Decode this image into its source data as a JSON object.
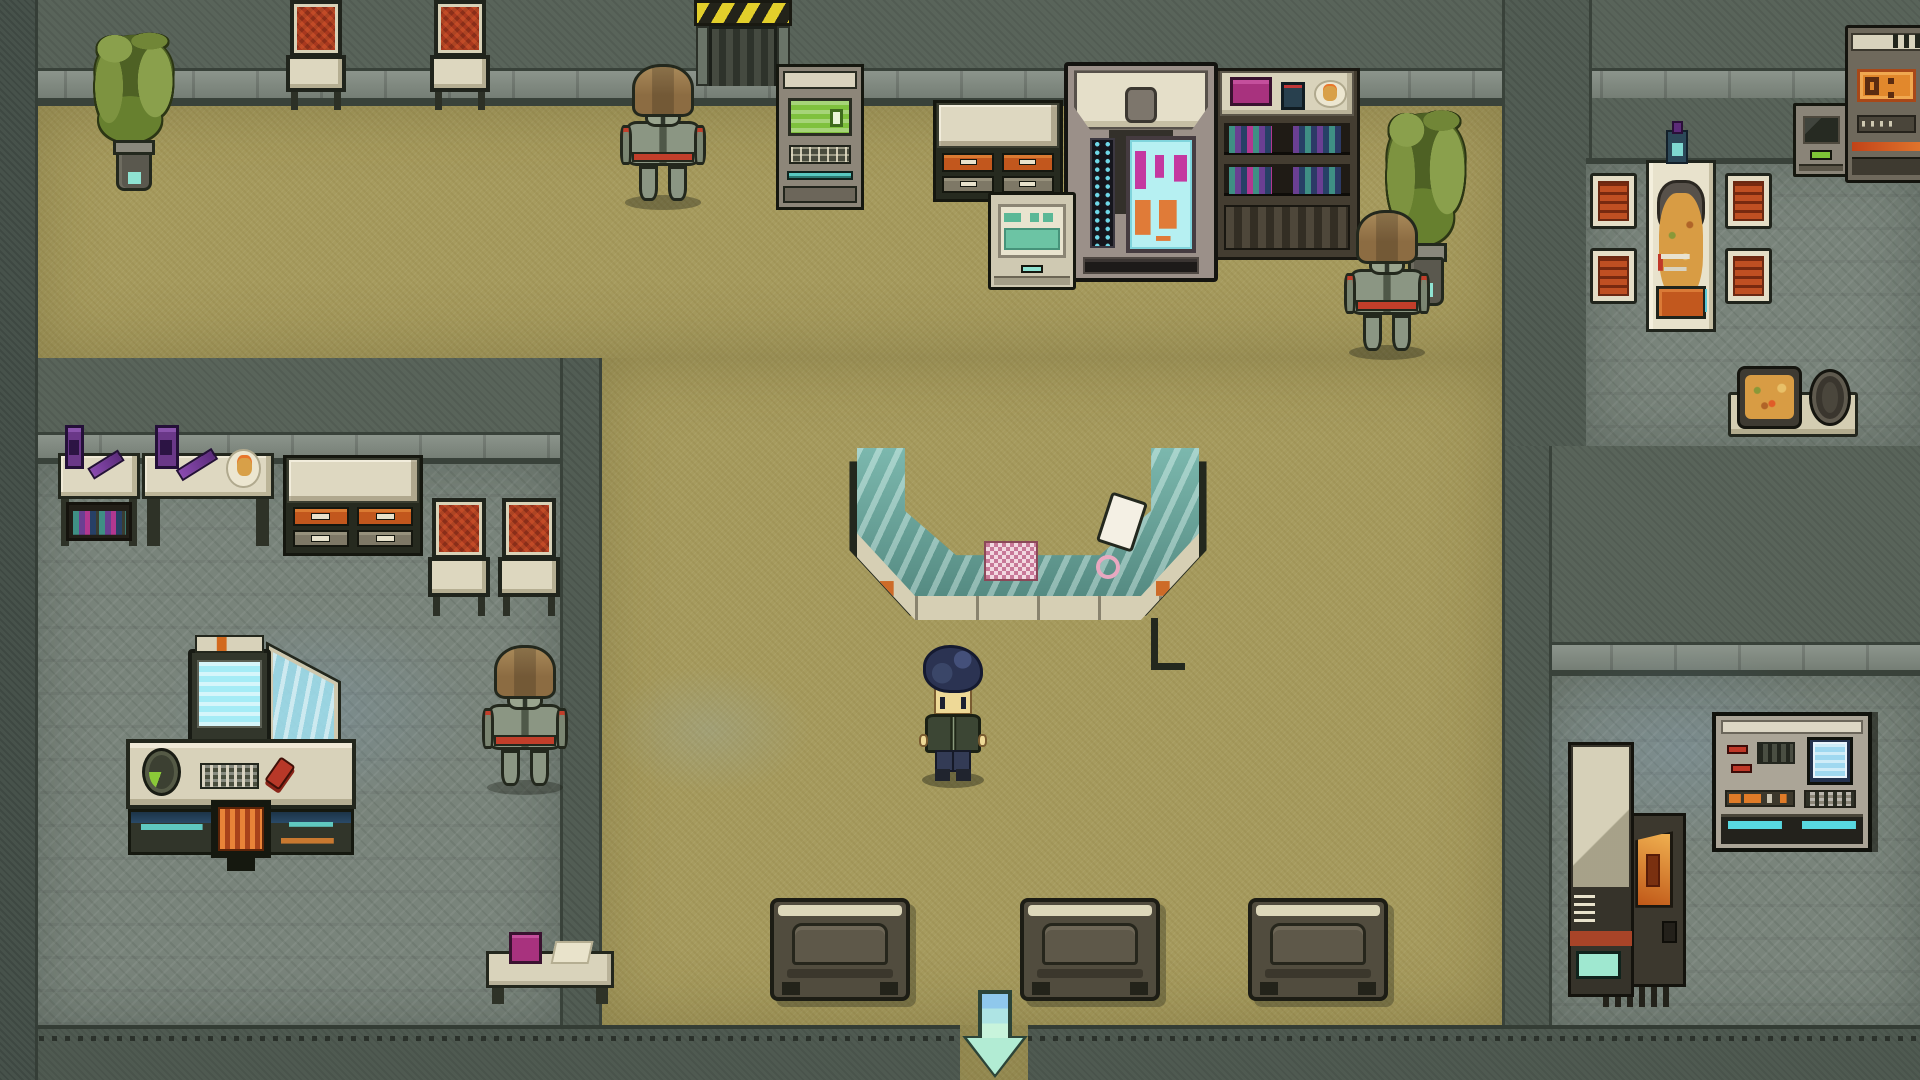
{
  "app": {
    "title": "top-down-pixel-rpg-interior",
    "view": "sci-fi lobby with service counter, side rooms, robot guards and exit arrow"
  },
  "palette": {
    "floor_tan": "#a69b5e",
    "floor_tile": "#79847b",
    "wall": "#59645a",
    "wall_trim": "#7c867c",
    "outline": "#23281d",
    "cream": "#ded8c1",
    "orange_accent": "#c2571d",
    "red_chair": "#a8381e",
    "robot_brown": "#8c6c42",
    "robot_armor": "#8b9683",
    "robot_red": "#c23e2a",
    "screen_green": "#7fc13d",
    "screen_cyan": "#b6f0f2",
    "magenta": "#c438a0",
    "teal": "#58c8c0",
    "glass_teal": "#639f95",
    "hazard_yellow": "#e3cf2b",
    "arrow_mint": "#b2ecd4",
    "player_hair": "#2b3352",
    "player_jacket": "#3c4634"
  },
  "hud": {
    "exit_arrow": {
      "direction": "down",
      "color": "#b2ecd4"
    }
  },
  "scene": {
    "width": 1920,
    "height": 1080,
    "regions": [
      {
        "kind": "wall-base",
        "name": "wall-background",
        "rect": [
          0,
          0,
          1920,
          1080
        ]
      },
      {
        "kind": "wall-face",
        "name": "top-wall",
        "rect": [
          0,
          0,
          1920,
          68
        ]
      },
      {
        "kind": "wall-trim",
        "name": "top-wall-trim",
        "rect": [
          0,
          68,
          1920,
          30
        ]
      },
      {
        "kind": "wall-shadow",
        "name": "top-wall-shadow",
        "rect": [
          0,
          98,
          1502,
          8
        ]
      },
      {
        "kind": "wall-face",
        "name": "dining-upper-wall",
        "rect": [
          1502,
          98,
          418,
          60
        ]
      },
      {
        "kind": "floor-tan",
        "name": "lobby-floor-upper",
        "rect": [
          35,
          106,
          1467,
          252
        ]
      },
      {
        "kind": "floor-tan",
        "name": "lobby-floor-main",
        "rect": [
          596,
          358,
          906,
          667
        ]
      },
      {
        "kind": "wall-face",
        "name": "left-room-top-wall",
        "rect": [
          35,
          358,
          561,
          74
        ]
      },
      {
        "kind": "wall-trim",
        "name": "left-room-wall-trim",
        "rect": [
          35,
          432,
          561,
          26
        ]
      },
      {
        "kind": "wall-shadow",
        "name": "left-room-wall-shadow",
        "rect": [
          35,
          458,
          561,
          6
        ]
      },
      {
        "kind": "floor-tile",
        "name": "left-room-floor",
        "rect": [
          35,
          464,
          525,
          561
        ]
      },
      {
        "kind": "wall-vert",
        "name": "left-room-right-wall",
        "rect": [
          560,
          358,
          36,
          722
        ]
      },
      {
        "kind": "wall-vert",
        "name": "lobby-dining-divider-wall",
        "rect": [
          1502,
          0,
          84,
          446
        ]
      },
      {
        "kind": "wall-shadow",
        "name": "dining-wall-shadow",
        "rect": [
          1586,
          158,
          334,
          6
        ]
      },
      {
        "kind": "floor-tile",
        "name": "dining-floor",
        "rect": [
          1586,
          164,
          334,
          282
        ]
      },
      {
        "kind": "wall-face",
        "name": "right-mid-wall",
        "rect": [
          1502,
          446,
          418,
          196
        ]
      },
      {
        "kind": "wall-trim",
        "name": "right-mid-wall-trim",
        "rect": [
          1546,
          642,
          374,
          28
        ]
      },
      {
        "kind": "wall-shadow",
        "name": "right-mid-wall-shadow",
        "rect": [
          1546,
          670,
          374,
          6
        ]
      },
      {
        "kind": "floor-tile",
        "name": "bottom-right-room-floor",
        "rect": [
          1546,
          676,
          374,
          349
        ]
      },
      {
        "kind": "wall-vert",
        "name": "bottom-right-room-left-wall",
        "rect": [
          1502,
          446,
          44,
          634
        ]
      },
      {
        "kind": "wall-bottom",
        "name": "bottom-wall",
        "rect": [
          0,
          1025,
          1920,
          55
        ]
      },
      {
        "kind": "wall-vert-dark",
        "name": "left-edge-wall",
        "rect": [
          0,
          0,
          35,
          1080
        ]
      },
      {
        "kind": "floor-tan",
        "name": "exit-corridor",
        "rect": [
          960,
          1025,
          68,
          55
        ]
      },
      {
        "kind": "glow",
        "name": "light-glow-workstation",
        "rect": [
          150,
          600,
          340,
          220
        ]
      },
      {
        "kind": "glow",
        "name": "light-glow-bottom-right",
        "rect": [
          1500,
          640,
          360,
          220
        ]
      },
      {
        "kind": "glow",
        "name": "light-glow-lobby",
        "rect": [
          600,
          660,
          220,
          140
        ]
      }
    ],
    "entities": [
      {
        "type": "plant",
        "name": "potted-plant-top-left",
        "x": 86,
        "y": 26,
        "w": 96,
        "h": 170,
        "interactable": false
      },
      {
        "type": "chair-south",
        "name": "chair-top-1",
        "x": 286,
        "y": 0,
        "w": 60,
        "h": 110,
        "interactable": false
      },
      {
        "type": "chair-south",
        "name": "chair-top-2",
        "x": 430,
        "y": 0,
        "w": 60,
        "h": 110,
        "interactable": false
      },
      {
        "type": "hazard-door",
        "name": "hazard-door",
        "x": 694,
        "y": 0,
        "w": 98,
        "h": 86,
        "interactable": true
      },
      {
        "type": "robot",
        "name": "robot-guard-top",
        "x": 620,
        "y": 64,
        "w": 86,
        "h": 146,
        "interactable": true
      },
      {
        "type": "atm",
        "name": "atm-machine",
        "x": 776,
        "y": 64,
        "w": 82,
        "h": 140,
        "interactable": true
      },
      {
        "type": "cabinet",
        "name": "supply-cabinet-top",
        "x": 933,
        "y": 100,
        "w": 124,
        "h": 96,
        "interactable": false
      },
      {
        "type": "terminal",
        "name": "print-terminal",
        "x": 988,
        "y": 192,
        "w": 82,
        "h": 92,
        "interactable": true
      },
      {
        "type": "vending",
        "name": "vending-machine",
        "x": 1064,
        "y": 62,
        "w": 146,
        "h": 212,
        "interactable": true
      },
      {
        "type": "bookshelf",
        "name": "bookshelf",
        "x": 1214,
        "y": 68,
        "w": 140,
        "h": 186,
        "interactable": false
      },
      {
        "type": "plant",
        "name": "potted-plant-right",
        "x": 1378,
        "y": 102,
        "w": 96,
        "h": 210,
        "interactable": false
      },
      {
        "type": "robot",
        "name": "robot-guard-right",
        "x": 1344,
        "y": 210,
        "w": 86,
        "h": 150,
        "interactable": true
      },
      {
        "type": "dining-set",
        "name": "dining-table-set",
        "x": 1590,
        "y": 130,
        "w": 182,
        "h": 215,
        "interactable": false
      },
      {
        "type": "food-tray",
        "name": "food-tray",
        "x": 1728,
        "y": 366,
        "w": 130,
        "h": 72,
        "interactable": false
      },
      {
        "type": "terminal-dark",
        "name": "corner-terminal",
        "x": 1793,
        "y": 103,
        "w": 50,
        "h": 68,
        "interactable": true
      },
      {
        "type": "corner-machine",
        "name": "corner-machine",
        "x": 1845,
        "y": 25,
        "w": 77,
        "h": 152,
        "interactable": true
      },
      {
        "type": "counter",
        "name": "service-counter",
        "x": 857,
        "y": 448,
        "w": 342,
        "h": 185,
        "interactable": true
      },
      {
        "type": "player",
        "name": "player-character",
        "x": 916,
        "y": 642,
        "w": 74,
        "h": 146,
        "interactable": true
      },
      {
        "type": "desk",
        "name": "desk-left-1",
        "x": 58,
        "y": 440,
        "w": 82,
        "h": 110,
        "interactable": false,
        "variant": "books"
      },
      {
        "type": "desk",
        "name": "desk-left-2",
        "x": 142,
        "y": 440,
        "w": 132,
        "h": 110,
        "interactable": false,
        "variant": "plate"
      },
      {
        "type": "cabinet",
        "name": "cabinet-left-room",
        "x": 283,
        "y": 455,
        "w": 134,
        "h": 95,
        "interactable": false
      },
      {
        "type": "chair-south",
        "name": "chair-left-1",
        "x": 428,
        "y": 498,
        "w": 62,
        "h": 118,
        "interactable": false
      },
      {
        "type": "chair-south",
        "name": "chair-left-2",
        "x": 498,
        "y": 498,
        "w": 62,
        "h": 118,
        "interactable": false
      },
      {
        "type": "workstation",
        "name": "computer-workstation",
        "x": 126,
        "y": 642,
        "w": 230,
        "h": 220,
        "interactable": true
      },
      {
        "type": "robot",
        "name": "robot-guard-left",
        "x": 482,
        "y": 645,
        "w": 86,
        "h": 150,
        "interactable": true
      },
      {
        "type": "side-table",
        "name": "side-table",
        "x": 486,
        "y": 932,
        "w": 128,
        "h": 72,
        "interactable": false
      },
      {
        "type": "bench",
        "name": "bench-1",
        "x": 770,
        "y": 898,
        "w": 132,
        "h": 95,
        "interactable": false
      },
      {
        "type": "bench",
        "name": "bench-2",
        "x": 1020,
        "y": 898,
        "w": 132,
        "h": 95,
        "interactable": false
      },
      {
        "type": "bench",
        "name": "bench-3",
        "x": 1248,
        "y": 898,
        "w": 132,
        "h": 95,
        "interactable": false
      },
      {
        "type": "arrow",
        "name": "exit-arrow",
        "x": 962,
        "y": 990,
        "w": 66,
        "h": 88,
        "interactable": true
      },
      {
        "type": "kiosk",
        "name": "server-kiosk",
        "x": 1568,
        "y": 742,
        "w": 118,
        "h": 255,
        "interactable": true
      },
      {
        "type": "console",
        "name": "control-console",
        "x": 1712,
        "y": 712,
        "w": 152,
        "h": 132,
        "interactable": true
      }
    ]
  }
}
